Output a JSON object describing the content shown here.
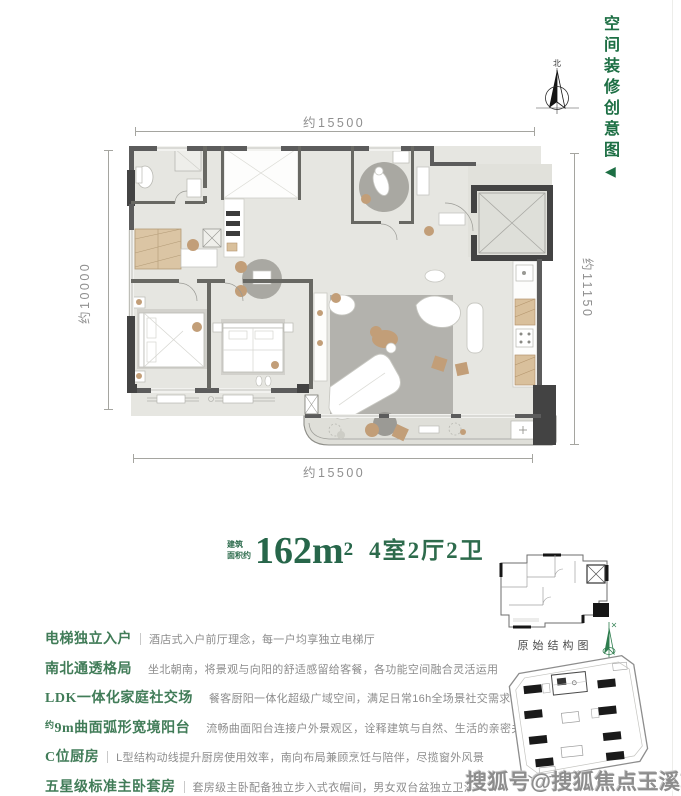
{
  "side_label": {
    "text": "空间装修创意图",
    "arrow": "◀"
  },
  "compass": {
    "north": "北"
  },
  "plan": {
    "dim_top": "约15500",
    "dim_left": "约10000",
    "dim_right": "约11150",
    "dim_bottom": "约15500"
  },
  "title": {
    "area_prefix_top": "建筑",
    "area_prefix_bottom": "面积约",
    "area_value": "162m",
    "area_sup": "2",
    "layout": "4室2厅2卫"
  },
  "features": [
    {
      "sup": "",
      "label": "电梯独立入户",
      "desc": "酒店式入户前厅理念，每一户均享独立电梯厅"
    },
    {
      "sup": "",
      "label": "南北通透格局",
      "desc": "坐北朝南，将景观与向阳的舒适感留给客餐，各功能空间融合灵活运用"
    },
    {
      "sup": "",
      "label": "LDK一体化家庭社交场",
      "desc": "餐客厨阳一体化超级广域空间，满足日常16h全场景社交需求"
    },
    {
      "sup": "约",
      "label": "9m曲面弧形宽境阳台",
      "desc": "流畅曲面阳台连接户外景观区，诠释建筑与自然、生活的亲密关系"
    },
    {
      "sup": "",
      "label": "C位厨房",
      "desc": "L型结构动线提升厨房使用效率，南向布局兼顾烹饪与陪伴，尽揽窗外风景"
    },
    {
      "sup": "",
      "label": "五星级标准主卧套房",
      "desc": "套房级主卧配备独立步入式衣帽间，男女双台盆独立卫浴"
    }
  ],
  "structure_diagram": {
    "caption": "原始结构图"
  },
  "watermark": {
    "text": "搜狐号@搜狐焦点玉溪站"
  },
  "colors": {
    "accent_green_dark": "#1d6f44",
    "accent_green": "#27664a",
    "label_green": "#417c58",
    "text_gray": "#8c8c8c",
    "wall_gray": "#5c5c5c",
    "tan": "#c29e78"
  }
}
